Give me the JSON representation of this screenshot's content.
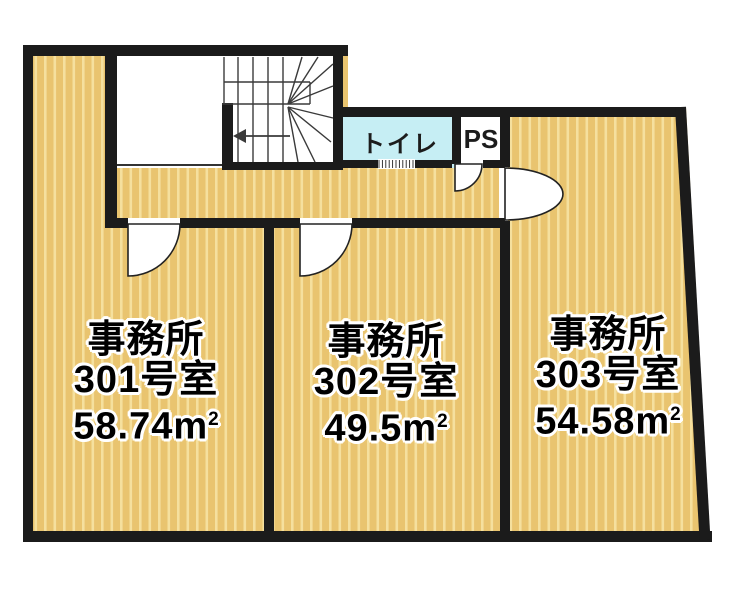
{
  "floorplan": {
    "rooms": [
      {
        "type_label": "事務所",
        "number_label": "301号室",
        "area_label": "58.74m",
        "area_sup": "2"
      },
      {
        "type_label": "事務所",
        "number_label": "302号室",
        "area_label": "49.5m",
        "area_sup": "2"
      },
      {
        "type_label": "事務所",
        "number_label": "303号室",
        "area_label": "54.58m",
        "area_sup": "2"
      }
    ],
    "facilities": {
      "toilet_label": "トイレ",
      "ps_label": "PS"
    },
    "stairs": {
      "arrow_icon": "left-arrow"
    },
    "colors": {
      "wall": "#1b1b1b",
      "floor_base": "#e9c46f",
      "floor_stripe": "#f5e09e",
      "toilet_fill": "#c6eef4",
      "stair_line": "#3a3a3a",
      "door_fill": "#ffffff"
    }
  }
}
